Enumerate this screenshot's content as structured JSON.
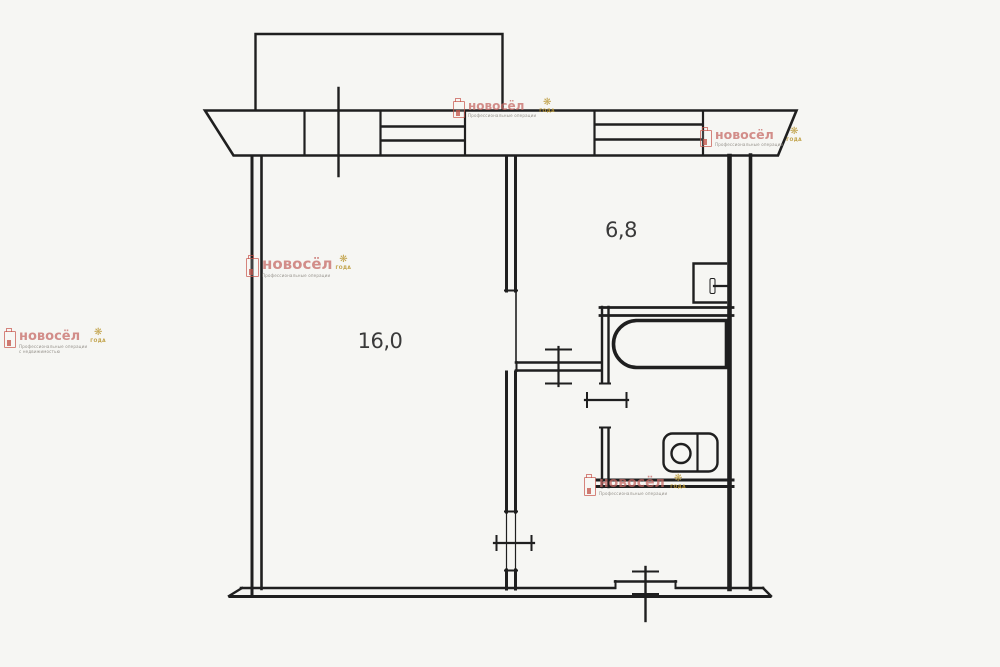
{
  "document": {
    "type": "apartment-floor-plan",
    "background_color": "#f6f6f3",
    "line_color": "#1f1f1f"
  },
  "plan": {
    "living_room": {
      "area_label": "16,0"
    },
    "kitchen": {
      "area_label": "6,8"
    },
    "fixtures": [
      "bathtub",
      "toilet",
      "kitchen-sink",
      "balcony",
      "window-band",
      "entrance-door-mark",
      "room-door-marks"
    ],
    "label_color": "#3a3a3a"
  },
  "watermark": {
    "brand": "новосёл",
    "tagline_line1": "Профессиональные операции",
    "tagline_line2": "с недвижимостью",
    "flower": "❋",
    "badge": "ГОДА",
    "colors": {
      "brand_pink": "#c66966",
      "logo_red": "#c6524a",
      "gold": "#bb9834",
      "tagline_grey": "#8e8a84"
    }
  }
}
